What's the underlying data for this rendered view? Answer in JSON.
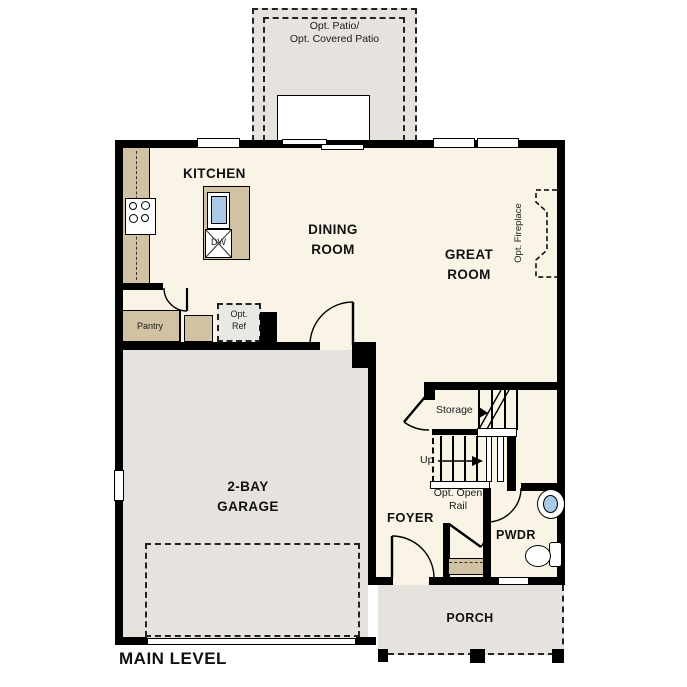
{
  "title": "MAIN LEVEL",
  "rooms": {
    "kitchen": {
      "label": "KITCHEN"
    },
    "dining_room": {
      "label": "DINING\nROOM"
    },
    "great_room": {
      "label": "GREAT\nROOM"
    },
    "garage": {
      "label": "2-BAY\nGARAGE"
    },
    "foyer": {
      "label": "FOYER"
    },
    "powder": {
      "label": "PWDR"
    },
    "porch": {
      "label": "PORCH"
    },
    "pantry": {
      "label": "Pantry"
    },
    "storage": {
      "label": "Storage"
    }
  },
  "annotations": {
    "opt_patio": {
      "label": "Opt. Patio/\nOpt. Covered Patio"
    },
    "opt_fireplace": {
      "label": "Opt. Fireplace"
    },
    "opt_ref": {
      "label": "Opt.\nRef"
    },
    "opt_open_rail": {
      "label": "Opt. Open\nRail"
    },
    "up": {
      "label": "Up"
    }
  },
  "appliances": {
    "dw": {
      "label": "DW"
    }
  },
  "colors": {
    "interior_floor": "#faf4e7",
    "garage_porch_patio_floor": "#e6e3df",
    "counter_tan": "#d1c2a4",
    "sink_blue": "#a9cbe8",
    "wall": "#000000"
  }
}
